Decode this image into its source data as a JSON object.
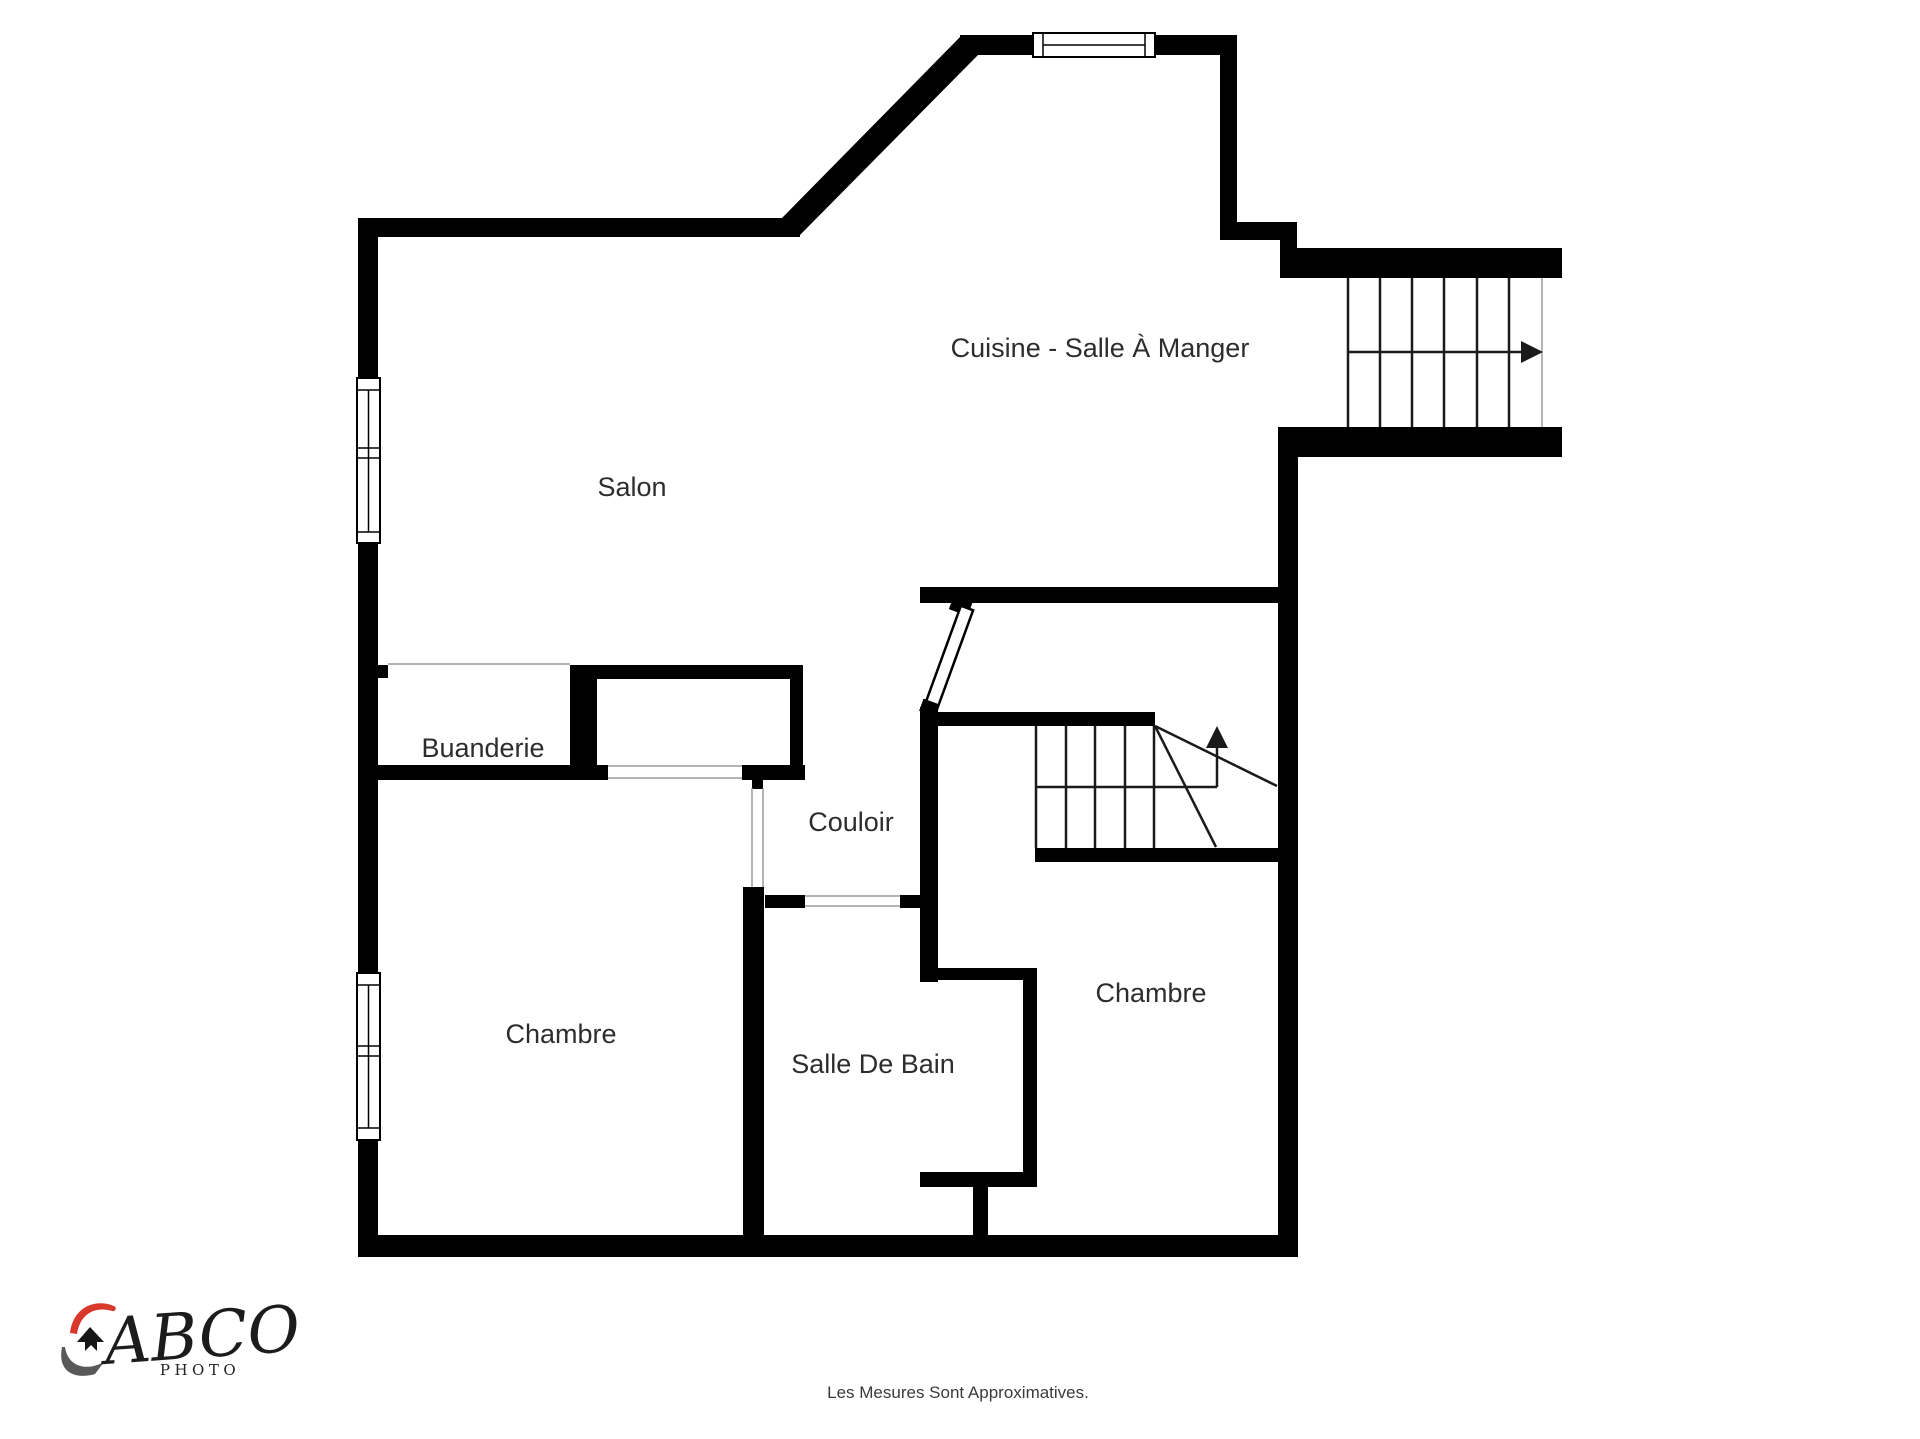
{
  "title": "Floor plan",
  "rooms": {
    "cuisine": "Cuisine - Salle À Manger",
    "salon": "Salon",
    "buanderie": "Buanderie",
    "couloir": "Couloir",
    "chambre_left": "Chambre",
    "salle_de_bain": "Salle De Bain",
    "chambre_right": "Chambre"
  },
  "footer": {
    "disclaimer": "Les Mesures Sont Approximatives."
  },
  "logo": {
    "brand": "ABCO",
    "sub": "PHOTO"
  },
  "colors": {
    "wall": "#000000",
    "label": "#2d2d2d",
    "logo_red": "#d9382c",
    "logo_gray": "#595959",
    "logo_black": "#161616"
  }
}
